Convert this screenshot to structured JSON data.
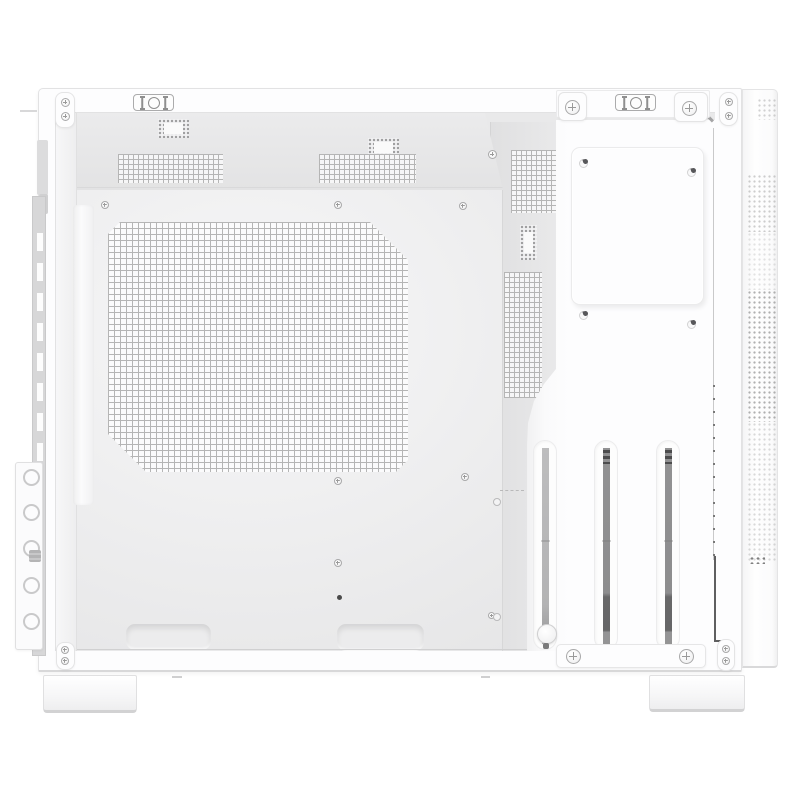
{
  "scene": {
    "type": "product-photo",
    "subject": "White micro-ATX PC case, side view with side panel removed, empty interior",
    "background": "#ffffff",
    "description": "Empty white computer case shown from the open side: perforated motherboard tray with large square-hole mesh, top ventilation mesh strips and cable-tie slots, rear wall vents, four-screw mounting plate, three vertical expansion-slot covers with thumbscrew, bottom tray cutouts and cable-tie clips, rear cable bracket with round holes, slotted rear exhaust strip, perforated front-panel edge and two case feet."
  },
  "palette": {
    "caseWhite": "#fdfdfd",
    "panelWhite": "#fbfbfc",
    "trayLight": "#f6f6f7",
    "trayMid": "#ececed",
    "trayDark": "#e4e4e5",
    "ceilingGrey": "#e8e8e9",
    "columnGrey": "#e3e3e4",
    "meshLine": "#b5b5b5",
    "ventDot": "#9c9c9c",
    "slotBar": "#909090",
    "slotBarDark": "#6d6d6d",
    "screwGrey": "#9a9a9a",
    "edgeLight": "#e3e3e3",
    "edgeMid": "#cfcfcf",
    "seamDark": "#5f5f60",
    "stripGrey": "#d7d7d8"
  },
  "parts": {
    "case": "PC case shell",
    "top_latch_cutouts": "Top-rail latch cutouts",
    "screw_tabs": "Thumbscrew corner tabs",
    "ceiling_vents": "Top ventilation mesh strips",
    "cable_tie_slots": "Cable-tie perforation slots",
    "motherboard_tray": "Motherboard tray",
    "tray_mesh": "Large perforated tray mesh",
    "standoff_screws": "Motherboard standoff screws",
    "tray_cutouts": "Bottom tray cutouts",
    "cable_tie_clips": "Bottom cable-tie clips",
    "rear_wall_vents": "Rear wall mesh vents",
    "mounting_plate": "Four-screw mounting plate",
    "expansion_slots": "Vertical expansion slot covers",
    "slot_bracket": "Expansion slot retention bracket",
    "front_panel_vent": "Front panel perforated edge",
    "rear_exhaust_strip": "Slotted rear exhaust strip",
    "rear_cable_bracket": "Rear cable-routing bracket",
    "feet": "Case feet"
  },
  "counts": {
    "expansion_slots": 3,
    "mounting_plate_screws": 4,
    "rear_bracket_holes": 5,
    "feet": 2,
    "top_latch_cutouts": 2,
    "ceiling_vent_strips": 2,
    "ceiling_tie_slots": 2,
    "bottom_tray_cutouts": 2,
    "bottom_cable_tie_clips": 2
  }
}
